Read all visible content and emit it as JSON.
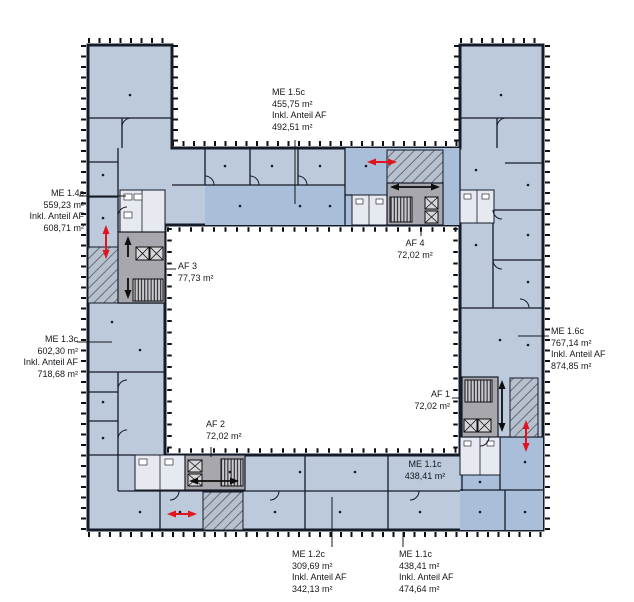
{
  "colors": {
    "room_light": "#bccadb",
    "room_mid": "#a9bed8",
    "core_gray": "#a7a7ad",
    "wc_white": "#e6eaf0",
    "wall_dark": "#161b28",
    "hatch_bg": "#b7c1ce",
    "hatch_line": "#5a6372",
    "red_arrow": "#e1131f",
    "background": "#ffffff"
  },
  "labels": {
    "me_1_5c": {
      "id": "ME 1.5c",
      "area": "455,75 m²",
      "incl": "Inkl. Anteil AF",
      "incl_area": "492,51 m²"
    },
    "me_1_4c": {
      "id": "ME 1.4c",
      "area": "559,23 m²",
      "incl": "Inkl. Anteil AF",
      "incl_area": "608,71 m²"
    },
    "me_1_3c": {
      "id": "ME 1.3c",
      "area": "602,30 m²",
      "incl": "Inkl. Anteil AF",
      "incl_area": "718,68 m²"
    },
    "me_1_6c": {
      "id": "ME 1.6c",
      "area": "767,14 m²",
      "incl": "Inkl. Anteil AF",
      "incl_area": "874,85 m²"
    },
    "me_1_2c": {
      "id": "ME 1.2c",
      "area": "309,69 m²",
      "incl": "Inkl. Anteil AF",
      "incl_area": "342,13 m²"
    },
    "me_1_1c": {
      "id": "ME 1.1c",
      "area": "438,41 m²",
      "incl": "Inkl. Anteil AF",
      "incl_area": "474,64 m²"
    },
    "me_1_1c_room": {
      "id": "ME 1.1c",
      "area": "438,41 m²"
    },
    "af_1": {
      "id": "AF 1",
      "area": "72,02 m²"
    },
    "af_2": {
      "id": "AF 2",
      "area": "72,02 m²"
    },
    "af_3": {
      "id": "AF 3",
      "area": "77,73 m²"
    },
    "af_4": {
      "id": "AF 4",
      "area": "72,02 m²"
    }
  }
}
